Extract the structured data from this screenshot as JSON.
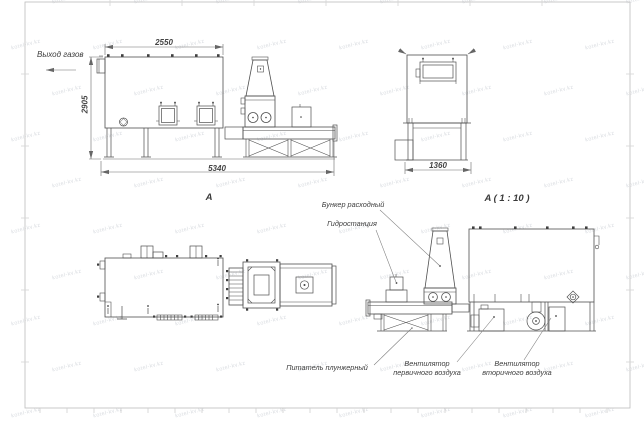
{
  "watermark": {
    "text": "kotel-kv.kz"
  },
  "colors": {
    "line": "#4f4f4f",
    "dim": "#6a6a6a",
    "frame": "#bdbdbd",
    "text": "#3d3d3d"
  },
  "labels": {
    "gas_outlet": "Выход газов",
    "view_a": "A",
    "view_a_scale": "A ( 1 : 10 )"
  },
  "dimensions": {
    "top_width": "2550",
    "height": "2905",
    "total_length": "5340",
    "front_width": "1360"
  },
  "callouts": {
    "hopper": "Бункер расходный",
    "hydraulic_station": "Гидростанция",
    "plunger_feeder": "Питатель плунжерный",
    "primary_air_fan": "Вентилятор первичного воздуха",
    "secondary_air_fan": "Вентилятор вторичного воздуха"
  }
}
